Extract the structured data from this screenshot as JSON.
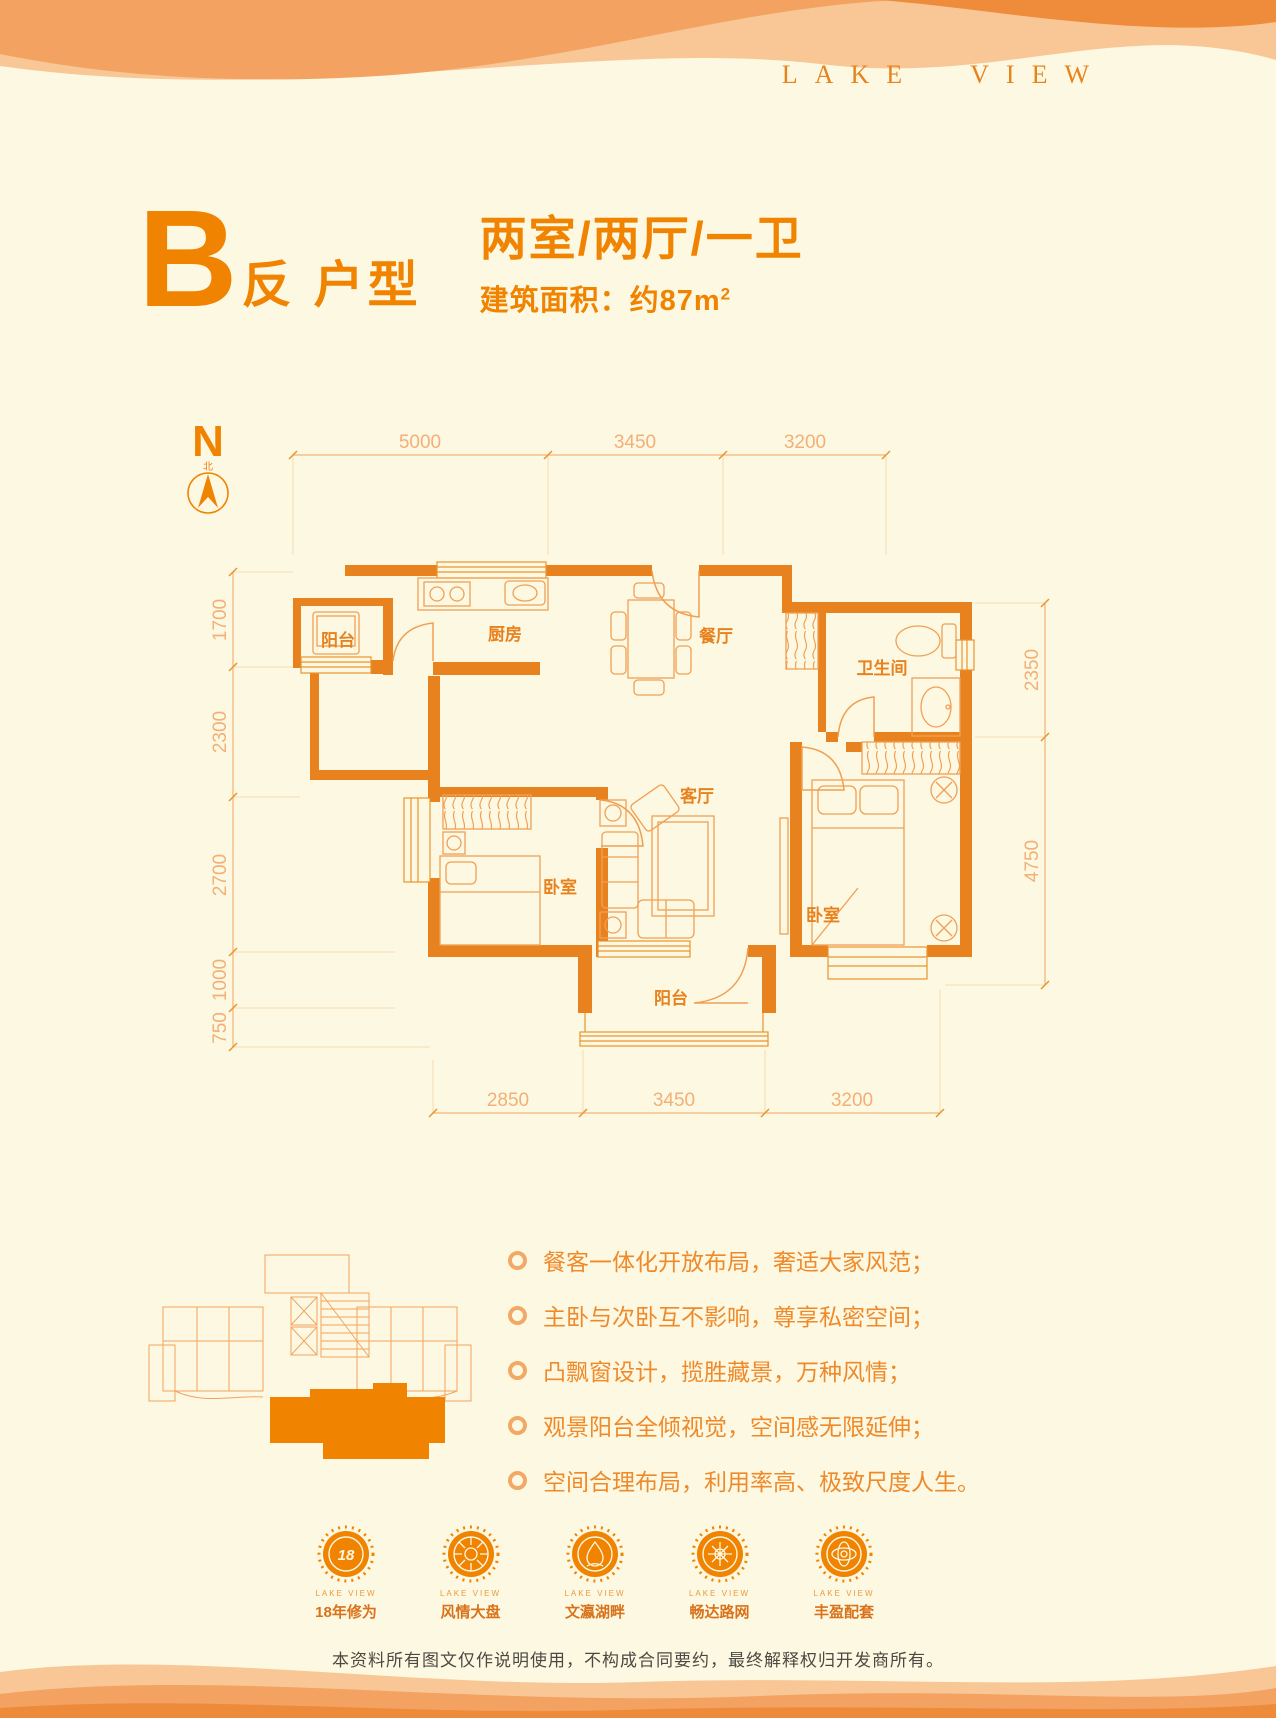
{
  "brand": {
    "logo": "LAKE VIEW"
  },
  "header": {
    "unit_letter": "B",
    "unit_suffix": "反 户型",
    "layout": "两室/两厅/一卫",
    "area": "建筑面积：约87m",
    "area_sup": "2"
  },
  "compass": {
    "n": "N",
    "north": "北"
  },
  "plan": {
    "rooms": {
      "balcony_top": "阳台",
      "kitchen": "厨房",
      "dining": "餐厅",
      "bathroom": "卫生间",
      "bedroom_left": "卧室",
      "living": "客厅",
      "bedroom_right": "卧室",
      "balcony_bottom": "阳台"
    },
    "dims": {
      "top": [
        "5000",
        "3450",
        "3200"
      ],
      "bottom": [
        "2850",
        "3450",
        "3200"
      ],
      "left": [
        "1700",
        "2300",
        "2700",
        "1000",
        "750"
      ],
      "right": [
        "2350",
        "4750"
      ]
    }
  },
  "features": {
    "items": [
      "餐客一体化开放布局，奢适大家风范；",
      "主卧与次卧互不影响，尊享私密空间；",
      "凸飘窗设计，揽胜藏景，万种风情；",
      "观景阳台全倾视觉，空间感无限延伸；",
      "空间合理布局，利用率高、极致尺度人生。"
    ]
  },
  "badges": {
    "items": [
      {
        "glyph": "18",
        "sub": "LAKE VIEW",
        "label": "18年修为"
      },
      {
        "glyph": "",
        "sub": "LAKE VIEW",
        "label": "风情大盘"
      },
      {
        "glyph": "",
        "sub": "LAKE VIEW",
        "label": "文瀛湖畔"
      },
      {
        "glyph": "",
        "sub": "LAKE VIEW",
        "label": "畅达路网"
      },
      {
        "glyph": "",
        "sub": "LAKE VIEW",
        "label": "丰盈配套"
      }
    ]
  },
  "disclaimer": "本资料所有图文仅作说明使用，不构成合同要约，最终解释权归开发商所有。",
  "colors": {
    "accent": "#F08300",
    "wall": "#E8821E",
    "dim_line": "#F0A35C",
    "cream": "#FDF8E2"
  }
}
